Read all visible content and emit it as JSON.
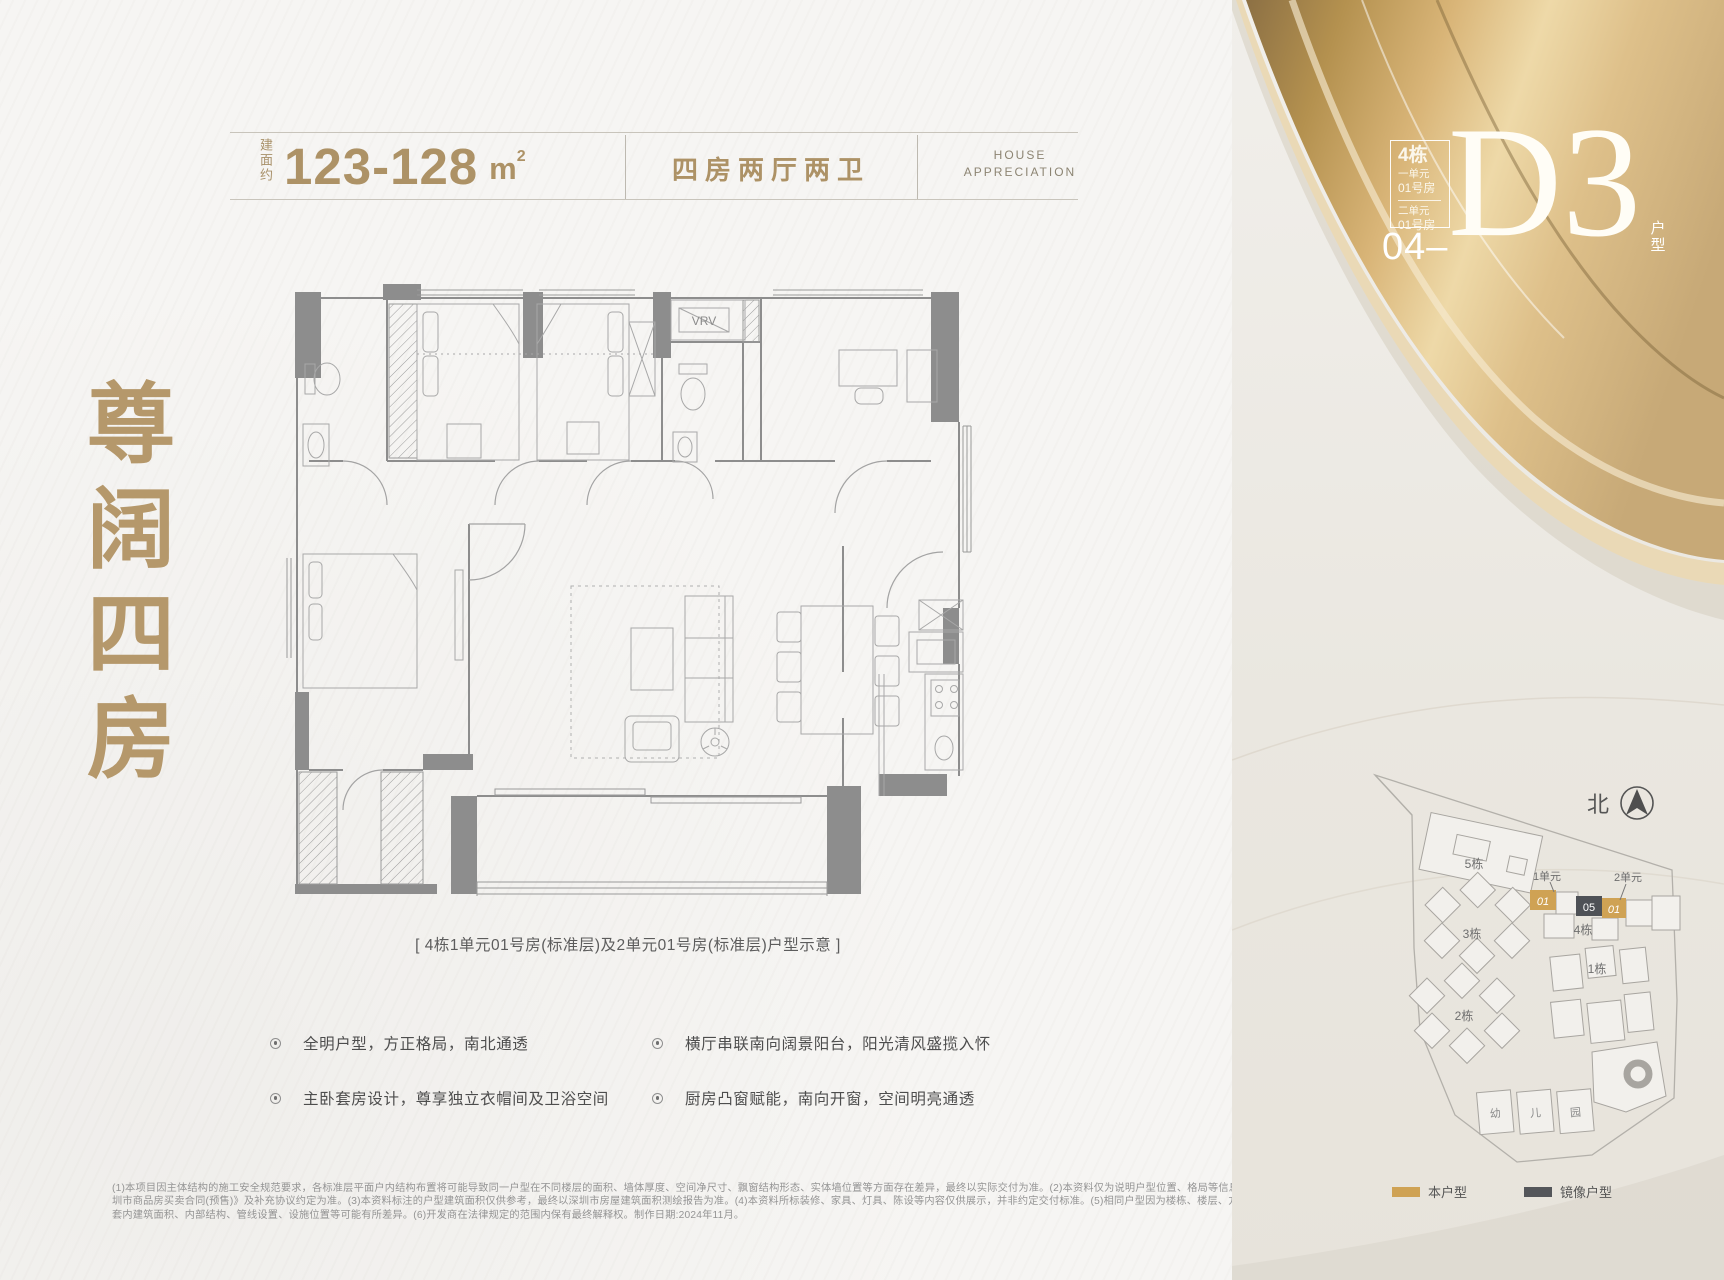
{
  "header": {
    "area_prefix": "建面约",
    "area_value": "123-128",
    "area_unit": "m",
    "area_sup": "2",
    "layout_label": "四房两厅两卫",
    "brand_line1": "HOUSE",
    "brand_line2": "APPRECIATION"
  },
  "unit_badge": {
    "building": "4栋",
    "unit1_name": "一单元",
    "unit1_room": "01号房",
    "unit2_name": "二单元",
    "unit2_room": "01号房",
    "code_prefix": "04",
    "code_dash": "–",
    "code": "D3",
    "code_suffix_1": "户",
    "code_suffix_2": "型"
  },
  "hero": {
    "c0": "尊",
    "c1": "阔",
    "c2": "四",
    "c3": "房"
  },
  "floorplan": {
    "vrv": "VRV",
    "caption": "[ 4栋1单元01号房(标准层)及2单元01号房(标准层)户型示意 ]"
  },
  "features": {
    "left": [
      "全明户型，方正格局，南北通透",
      "主卧套房设计，尊享独立衣帽间及卫浴空间"
    ],
    "right": [
      "横厅串联南向阔景阳台，阳光清风盛揽入怀",
      "厨房凸窗赋能，南向开窗，空间明亮通透"
    ]
  },
  "disclaimer": {
    "l1": "(1)本项目因主体结构的施工安全规范要求，各标准层平面户内结构布置将可能导致同一户型在不同楼层的面积、墙体厚度、空间净尺寸、飘窗结构形态、实体墙位置等方面存在差异，最终以实际交付为准。(2)本资料仅为说明户型位置、格局等信息，最终交付标准以《深",
    "l2": "圳市商品房买卖合同(预售)》及补充协议约定为准。(3)本资料标注的户型建筑面积仅供参考，最终以深圳市房屋建筑面积测绘报告为准。(4)本资料所标装修、家具、灯具、陈设等内容仅供展示，并非约定交付标准。(5)相同户型因为楼栋、楼层、方位等因素的不同，其实际",
    "l3": "套内建筑面积、内部结构、管线设置、设施位置等可能有所差异。(6)开发商在法律规定的范围内保有最终解释权。制作日期:2024年11月。"
  },
  "siteplan": {
    "north": "北",
    "b5": "5栋",
    "b3": "3栋",
    "b2": "2栋",
    "b1": "1栋",
    "b4": "4栋",
    "u1": "1单元",
    "u2": "2单元",
    "unit_a": "01",
    "unit_b": "05",
    "unit_c": "01",
    "kg1": "幼",
    "kg2": "儿",
    "kg3": "园",
    "legend_self": "本户型",
    "legend_mirror": "镜像户型"
  },
  "colors": {
    "gold_text": "#ad9266",
    "hero_gold": "#b5986b",
    "ribbon_gold": "#d9b578",
    "unit_self": "#cfa254",
    "unit_mirror": "#4e5156",
    "wall_gray": "#8d8d8d"
  }
}
